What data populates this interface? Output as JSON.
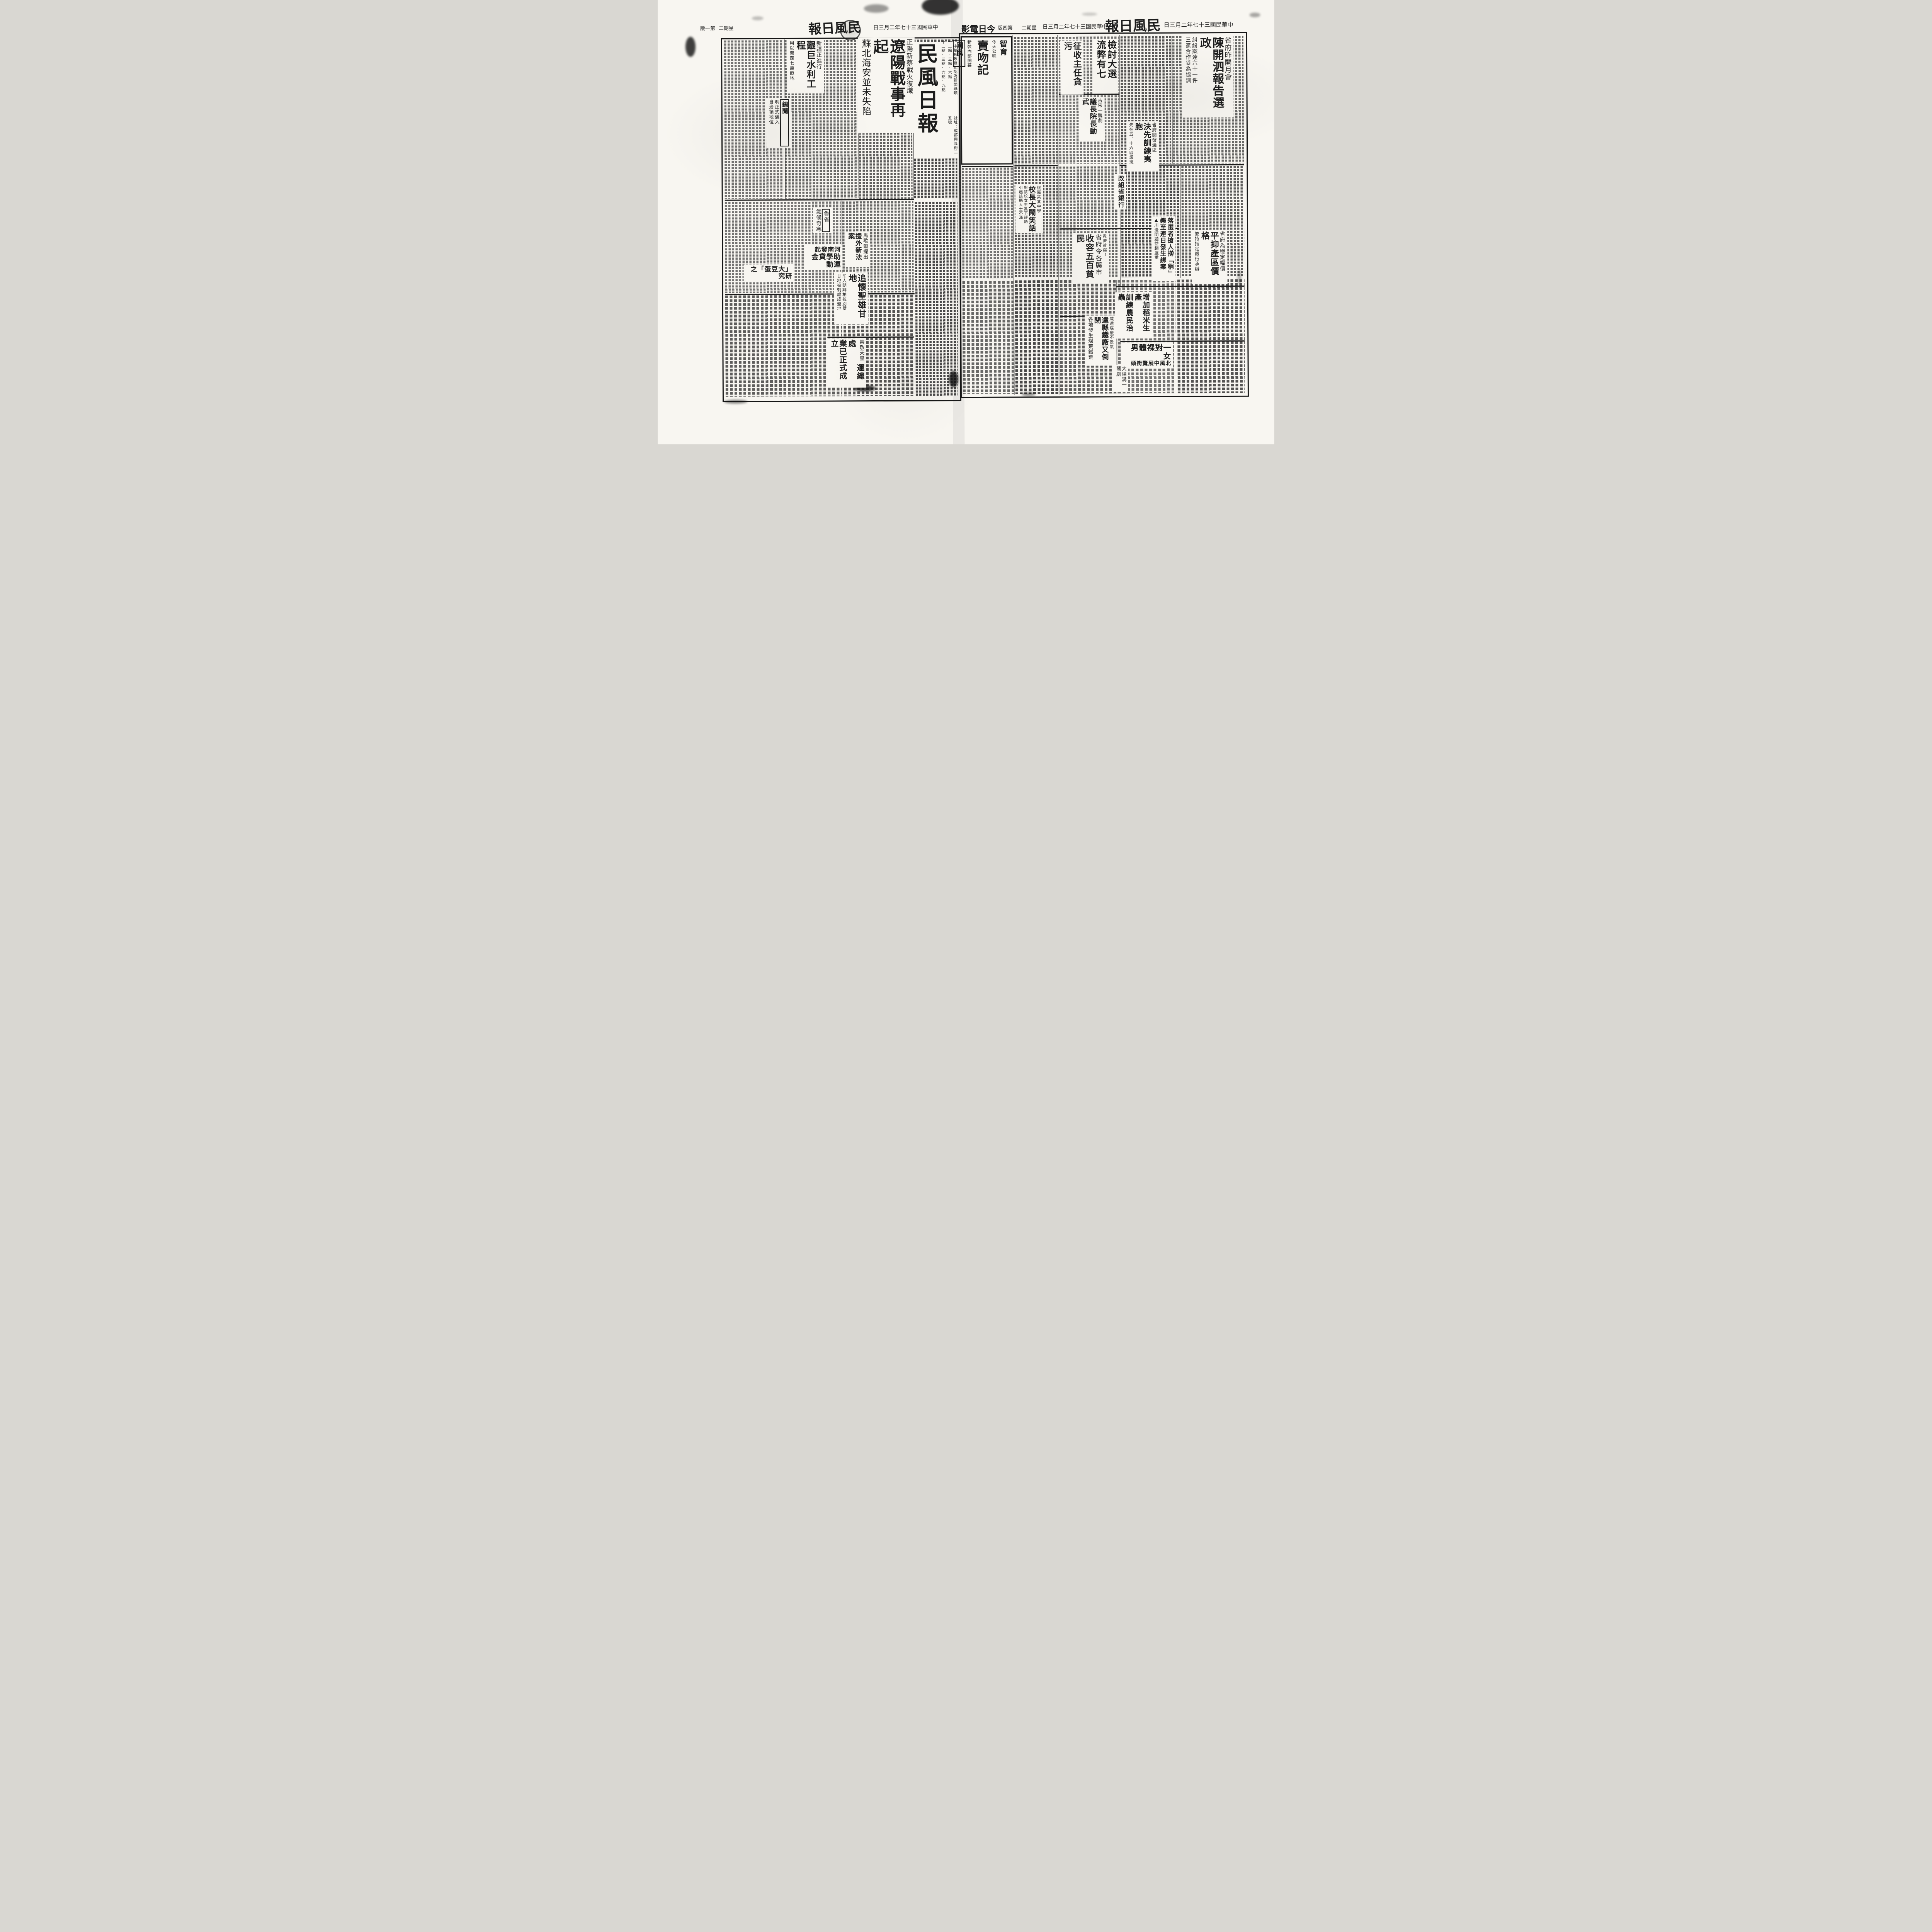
{
  "paper": {
    "name": "民風日報",
    "ink_color": "#1c1c1c",
    "paper_color": "#f8f6f1"
  },
  "left": {
    "folio": {
      "edition": "第一版",
      "weekday": "星期二",
      "masthead": "民風日報",
      "date": "中華民國三十七年二月三日"
    },
    "nameplate": {
      "title": "民風日報",
      "registration": "中華郵政登記認為新聞紙類",
      "address": "社址：成都興隆街二五號"
    },
    "articles": {
      "xinjiang": {
        "kicker": "新疆正進行",
        "title": "艱巨水利工程",
        "subtitle": "用以開闢七萬畝地"
      },
      "ceylon": {
        "title": "錫蘭",
        "leader": "……",
        "sub1": "明正式邁入",
        "sub2": "自治領地位",
        "dateline": "【中央社南京二日電】"
      },
      "liaoyang": {
        "kicker": "正陽新蔡戰火復熾",
        "title": "遼陽戰事再起",
        "subtitle": "蘇北海安並未失陷",
        "dateline": "【中央社漢口二日電】"
      },
      "shandong": {
        "kicker": "魯省",
        "title": "氣候奇寒"
      },
      "henan": {
        "kicker": "河南發起",
        "title": "助學貸金運動"
      },
      "marshall": {
        "kicker": "馬歇爾提出",
        "title": "援外新法案"
      },
      "gandhi": {
        "title": "追懷聖雄甘地",
        "sub1": "印人朝拜柏拉別墅",
        "sub2": "甘地被刺處成聖地"
      },
      "soybean": {
        "title": "「大豆蛋」之研究"
      },
      "jiaobu": {
        "title1": "交部儲運總處",
        "title2": "業已正式成立"
      },
      "tenno": {
        "title": "崇敬天皇"
      }
    }
  },
  "right": {
    "folio": {
      "edition": "第四版",
      "weekday": "星期二",
      "date": "中華民國三十七年二月三日",
      "masthead": "民風日報",
      "date_right": "中華民國三十七年二月三日"
    },
    "cinema": {
      "header": "今日電影",
      "theater1": "智育",
      "film1": "賣吻記",
      "note1": "今天公映",
      "times1": "十二點‧三點‧六點",
      "theater2": "國民",
      "note2": "新裝內部開幕",
      "times2": "十二點‧三點‧六點‧九點"
    },
    "articles": {
      "tax": {
        "title": "征收主任貪污"
      },
      "election_review": {
        "title1": "檢討大選",
        "title2": "流弊有七"
      },
      "council_fight": {
        "kicker": "古宋一醜劇",
        "title": "議長院長動武"
      },
      "monthly_meeting": {
        "kicker": "省府昨開月會",
        "title": "陳開泗報告選政",
        "sub1": "糾紛案達六十一件",
        "sub2": "三黨合作妥為協調"
      },
      "train_yi": {
        "kicker": "省府開發邊區",
        "title": "決先訓練夷胞",
        "subtitle": "先在五、十六區設班"
      },
      "bank": {
        "title": "改組省銀行"
      },
      "grain_price": {
        "kicker": "省府為穩定糧價",
        "title": "平抑產區價格",
        "subtitle": "並特指定銀行承辦"
      },
      "kidnap": {
        "title1": "落選者搶人撈「稍」",
        "title2": "樂至連日發生綁案",
        "side": "▲川邊問題益趨嚴重"
      },
      "poor_relief": {
        "kicker": "救濟貧弱！",
        "title1": "省府令各縣市",
        "title2": "收容五百貧民"
      },
      "school": {
        "kicker": "綏屬某某中學",
        "title": "校長大鬧笑話",
        "sub1": "對該校女生亂下評語",
        "sub2": "引起該縣人士不滿"
      },
      "rice_pest": {
        "title1": "增加稻米生產",
        "title2": "訓練農民治蟲"
      },
      "iron": {
        "kicker": "威遠煤廠不景氣",
        "title": "達縣鐵廠又倒閉",
        "subtitle": "各地發生煤荒鐵荒"
      },
      "nude": {
        "title": "一對裸體男女",
        "subtitle": "北風中展覽街頭"
      },
      "farce": {
        "title": "大陽溝一鬧劇"
      }
    }
  }
}
